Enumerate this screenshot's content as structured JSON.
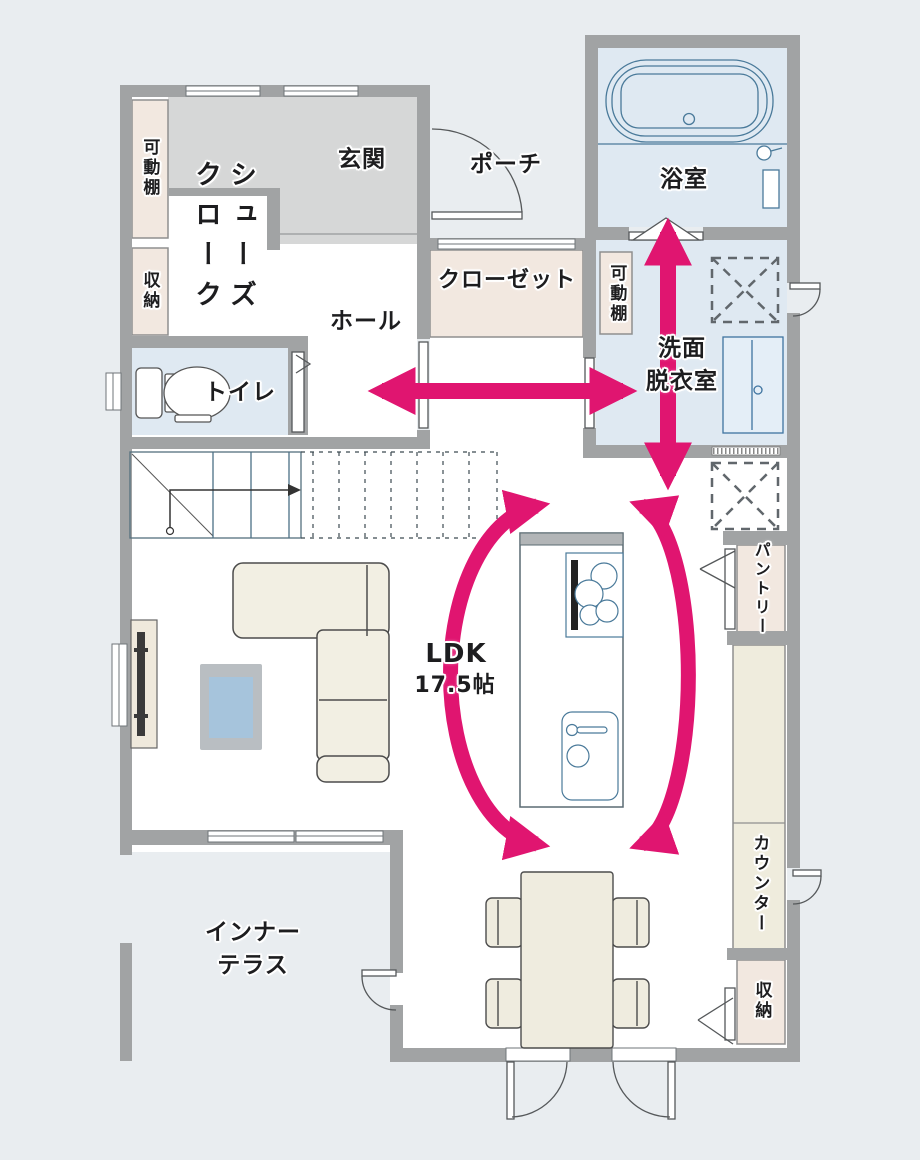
{
  "plan_title": "1F floor plan",
  "labels": {
    "entrance": "玄関",
    "shoe_closet": "シューズ\nクローク",
    "movable_shelf_entrance": "可動棚",
    "storage_entrance": "収納",
    "hall": "ホール",
    "toilet": "トイレ",
    "porch": "ポーチ",
    "bathroom": "浴室",
    "closet": "クローゼット",
    "movable_shelf_washroom": "可動棚",
    "washroom": "洗面\n脱衣室",
    "ldk_name": "LDK",
    "ldk_size": "17.5帖",
    "pantry": "パントリー",
    "counter": "カウンター",
    "storage_ldk": "収納",
    "inner_terrace": "インナー\nテラス"
  },
  "palette": {
    "background": "#e9edf0",
    "wall": "#a1a3a4",
    "floor_white": "#ffffff",
    "entrance_floor_gray": "#d6d7d7",
    "wet_room_blue": "#dfe9f2",
    "storage_beige": "#f2e8e0",
    "furniture_cream": "#f0ecdf",
    "fixture_line_blue": "#4a7a9a",
    "accent_pink": "#e01570",
    "rug_gray": "#b9bec2",
    "rug_blue": "#a6c4dc"
  },
  "flow_arrows": [
    "washroom-to-bathroom-vertical",
    "hall-to-washroom-horizontal",
    "kitchen-island-loop-left",
    "kitchen-island-loop-right"
  ]
}
